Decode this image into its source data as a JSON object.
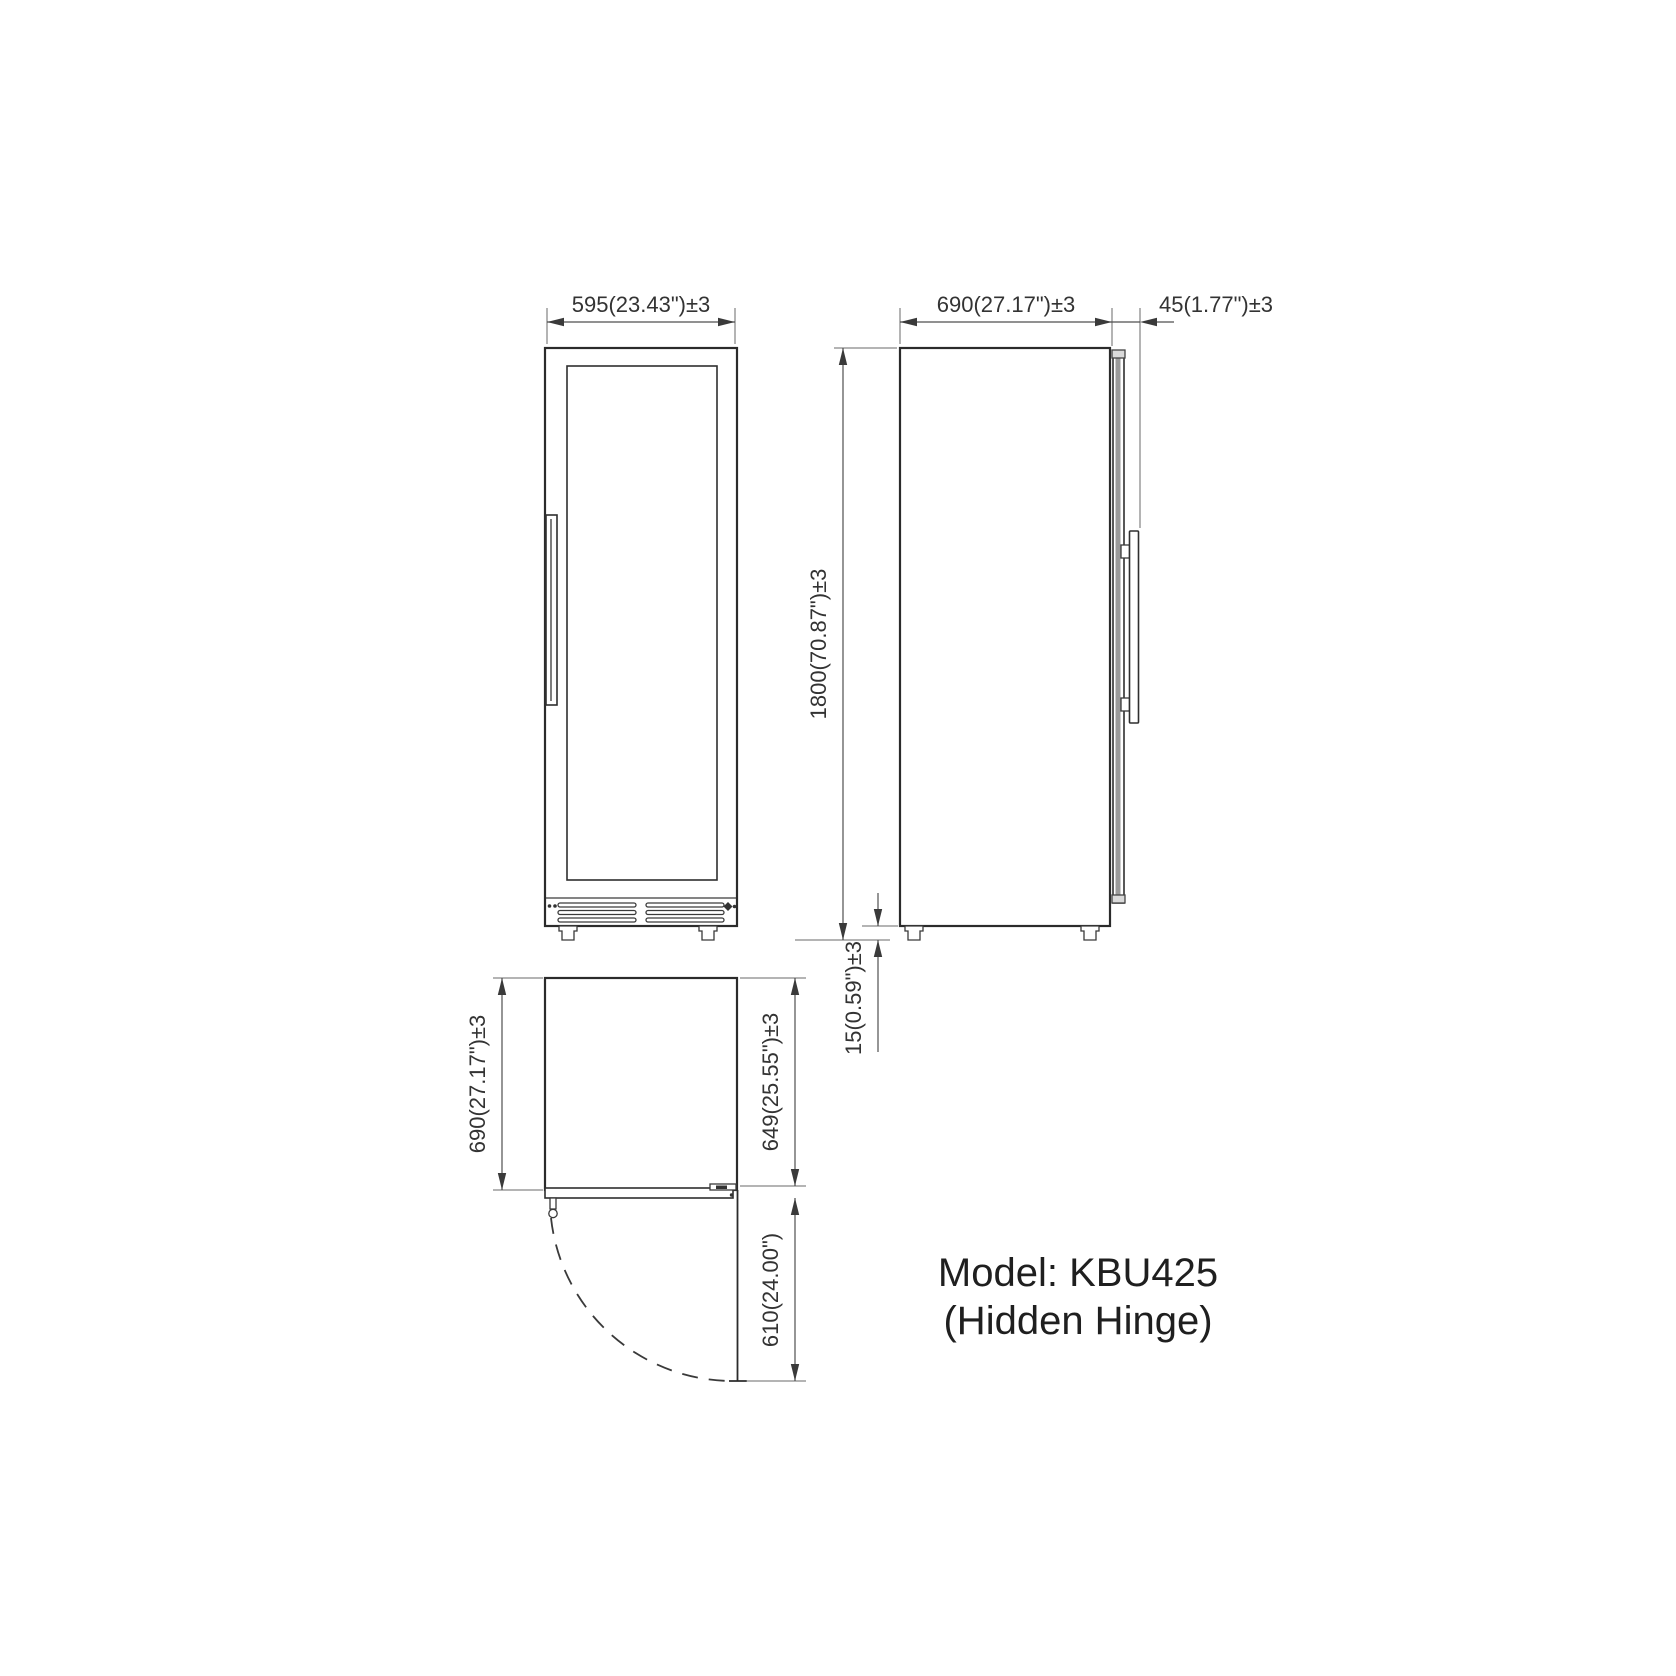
{
  "model_label": {
    "line1": "Model: KBU425",
    "line2": "(Hidden Hinge)"
  },
  "dimensions": {
    "front_width": "595(23.43\")±3",
    "side_depth": "690(27.17\")±3",
    "door_protrusion": "45(1.77\")±3",
    "overall_height": "1800(70.87\")±3",
    "foot_height": "15(0.59\")±3",
    "top_depth": "690(27.17\")±3",
    "depth_without_door": "649(25.55\")±3",
    "door_swing_depth": "610(24.00\")"
  },
  "colors": {
    "outline": "#2b2b2b",
    "dimension_line": "#4f4f4f",
    "text": "#333333",
    "background": "#ffffff"
  }
}
